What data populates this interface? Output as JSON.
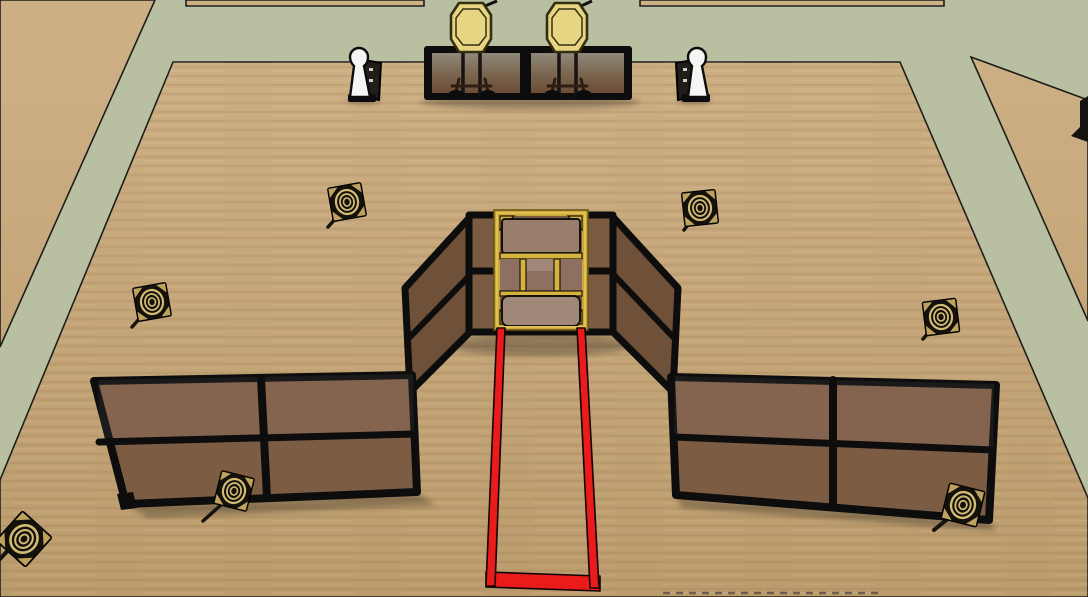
{
  "scene": {
    "title": "3D shooting-stage layout view",
    "description": "Overhead 3D view of a pistol stage bay: grass paths, tan bay floor, plywood walls, a center shooting port with yellow frame, red fault-line lane, two paper targets on stands behind a low wall, two steel poppers and seven small plate targets",
    "colors": {
      "grass": "#b9c0a1",
      "floor": "#c5a67a",
      "floor_light": "#cdaf84",
      "floor_dark": "#bc9c6d",
      "wall_panel": "#7d5c44",
      "angled_wall_panel": "#6f5039",
      "center_wall_panel": "#7c5b43",
      "frame_black": "#0d0d0d",
      "port_yellow": "#caa93c",
      "port_yellow_bright": "#d6b23f",
      "port_panel_top": "#9a7e6c",
      "port_panel_bottom": "#a08878",
      "port_window": "#8d7060",
      "target_paper": "#e7d584",
      "target_outline": "#33300f",
      "popper_white": "#f5f5f3",
      "stand_dark": "#211d18",
      "fault_red": "#ea1b1b",
      "plate_rings": "#d3bc72",
      "plate_black": "#14110d",
      "top_panel_top": "#918b7d",
      "top_panel_mid": "#7d6b55",
      "top_panel_bottom": "#6b4b35"
    },
    "objects": {
      "paper_target_count": 2,
      "popper_count": 2,
      "mini_plate_count": 7,
      "walls": [
        "top target wall",
        "left wall",
        "right wall",
        "center port structure"
      ],
      "fault_line": "red shooter lane"
    }
  }
}
